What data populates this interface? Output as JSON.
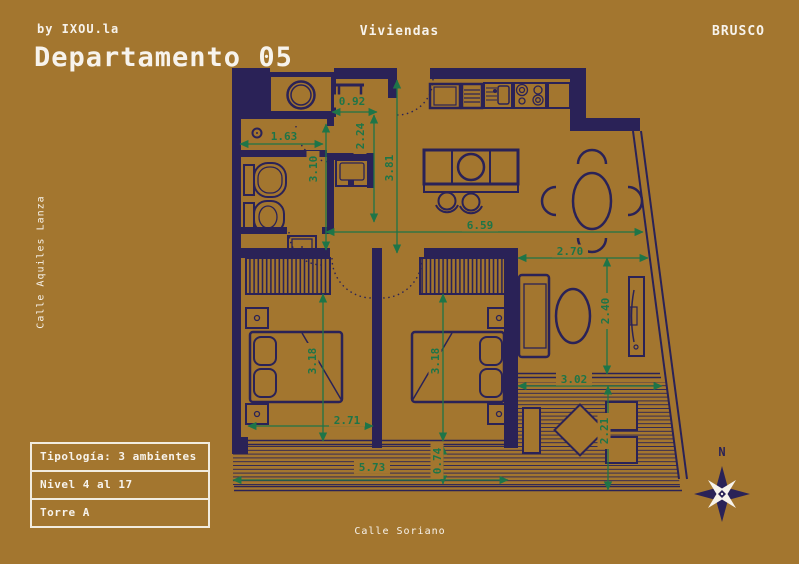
{
  "colors": {
    "background": "#a3762f",
    "plan_line": "#2a2257",
    "dimension": "#1e7548",
    "text": "#f7f3ec"
  },
  "header": {
    "byline": "by IXOU.la",
    "title": "Departamento 05",
    "center_label": "Viviendas",
    "brand": "BRUSCO"
  },
  "streets": {
    "left": "Calle Aquiles Lanza",
    "bottom": "Calle Soriano"
  },
  "info_box": {
    "rows": [
      {
        "label": "Tipología: 3 ambientes"
      },
      {
        "label": "Nivel 4 al 17"
      },
      {
        "label": "Torre A"
      }
    ]
  },
  "compass": {
    "label": "N"
  },
  "plan": {
    "dimensions": [
      {
        "value": "0.92",
        "orientation": "horizontal",
        "axis": 112,
        "from": 332,
        "to": 377,
        "label_x": 352,
        "label_y": 101
      },
      {
        "value": "1.63",
        "orientation": "horizontal",
        "axis": 144,
        "from": 240,
        "to": 323,
        "label_x": 284,
        "label_y": 136
      },
      {
        "value": "2.24",
        "orientation": "vertical",
        "axis": 374,
        "from": 115,
        "to": 222,
        "label_x": 360,
        "label_y": 136
      },
      {
        "value": "3.10",
        "orientation": "vertical",
        "axis": 326,
        "from": 124,
        "to": 250,
        "label_x": 313,
        "label_y": 169
      },
      {
        "value": "3.81",
        "orientation": "vertical",
        "axis": 397,
        "from": 80,
        "to": 253,
        "label_x": 389,
        "label_y": 168
      },
      {
        "value": "6.59",
        "orientation": "horizontal",
        "axis": 232,
        "from": 326,
        "to": 643,
        "label_x": 480,
        "label_y": 225
      },
      {
        "value": "2.70",
        "orientation": "horizontal",
        "axis": 258,
        "from": 518,
        "to": 648,
        "label_x": 570,
        "label_y": 251
      },
      {
        "value": "2.40",
        "orientation": "vertical",
        "axis": 607,
        "from": 258,
        "to": 374,
        "label_x": 605,
        "label_y": 311
      },
      {
        "value": "3.18",
        "orientation": "vertical",
        "axis": 323,
        "from": 294,
        "to": 441,
        "label_x": 312,
        "label_y": 361
      },
      {
        "value": "3.18",
        "orientation": "vertical",
        "axis": 443,
        "from": 294,
        "to": 441,
        "label_x": 435,
        "label_y": 361
      },
      {
        "value": "3.02",
        "orientation": "horizontal",
        "axis": 386,
        "from": 518,
        "to": 662,
        "label_x": 574,
        "label_y": 379
      },
      {
        "value": "2.71",
        "orientation": "horizontal",
        "axis": 426,
        "from": 248,
        "to": 373,
        "label_x": 347,
        "label_y": 420
      },
      {
        "value": "2.21",
        "orientation": "vertical",
        "axis": 608,
        "from": 386,
        "to": 490,
        "label_x": 604,
        "label_y": 431
      },
      {
        "value": "5.73",
        "orientation": "horizontal",
        "axis": 480,
        "from": 233,
        "to": 508,
        "label_x": 372,
        "label_y": 467
      },
      {
        "value": "0.74",
        "orientation": "vertical",
        "axis": 443,
        "from": 446,
        "to": 484,
        "label_x": 437,
        "label_y": 461
      }
    ]
  }
}
